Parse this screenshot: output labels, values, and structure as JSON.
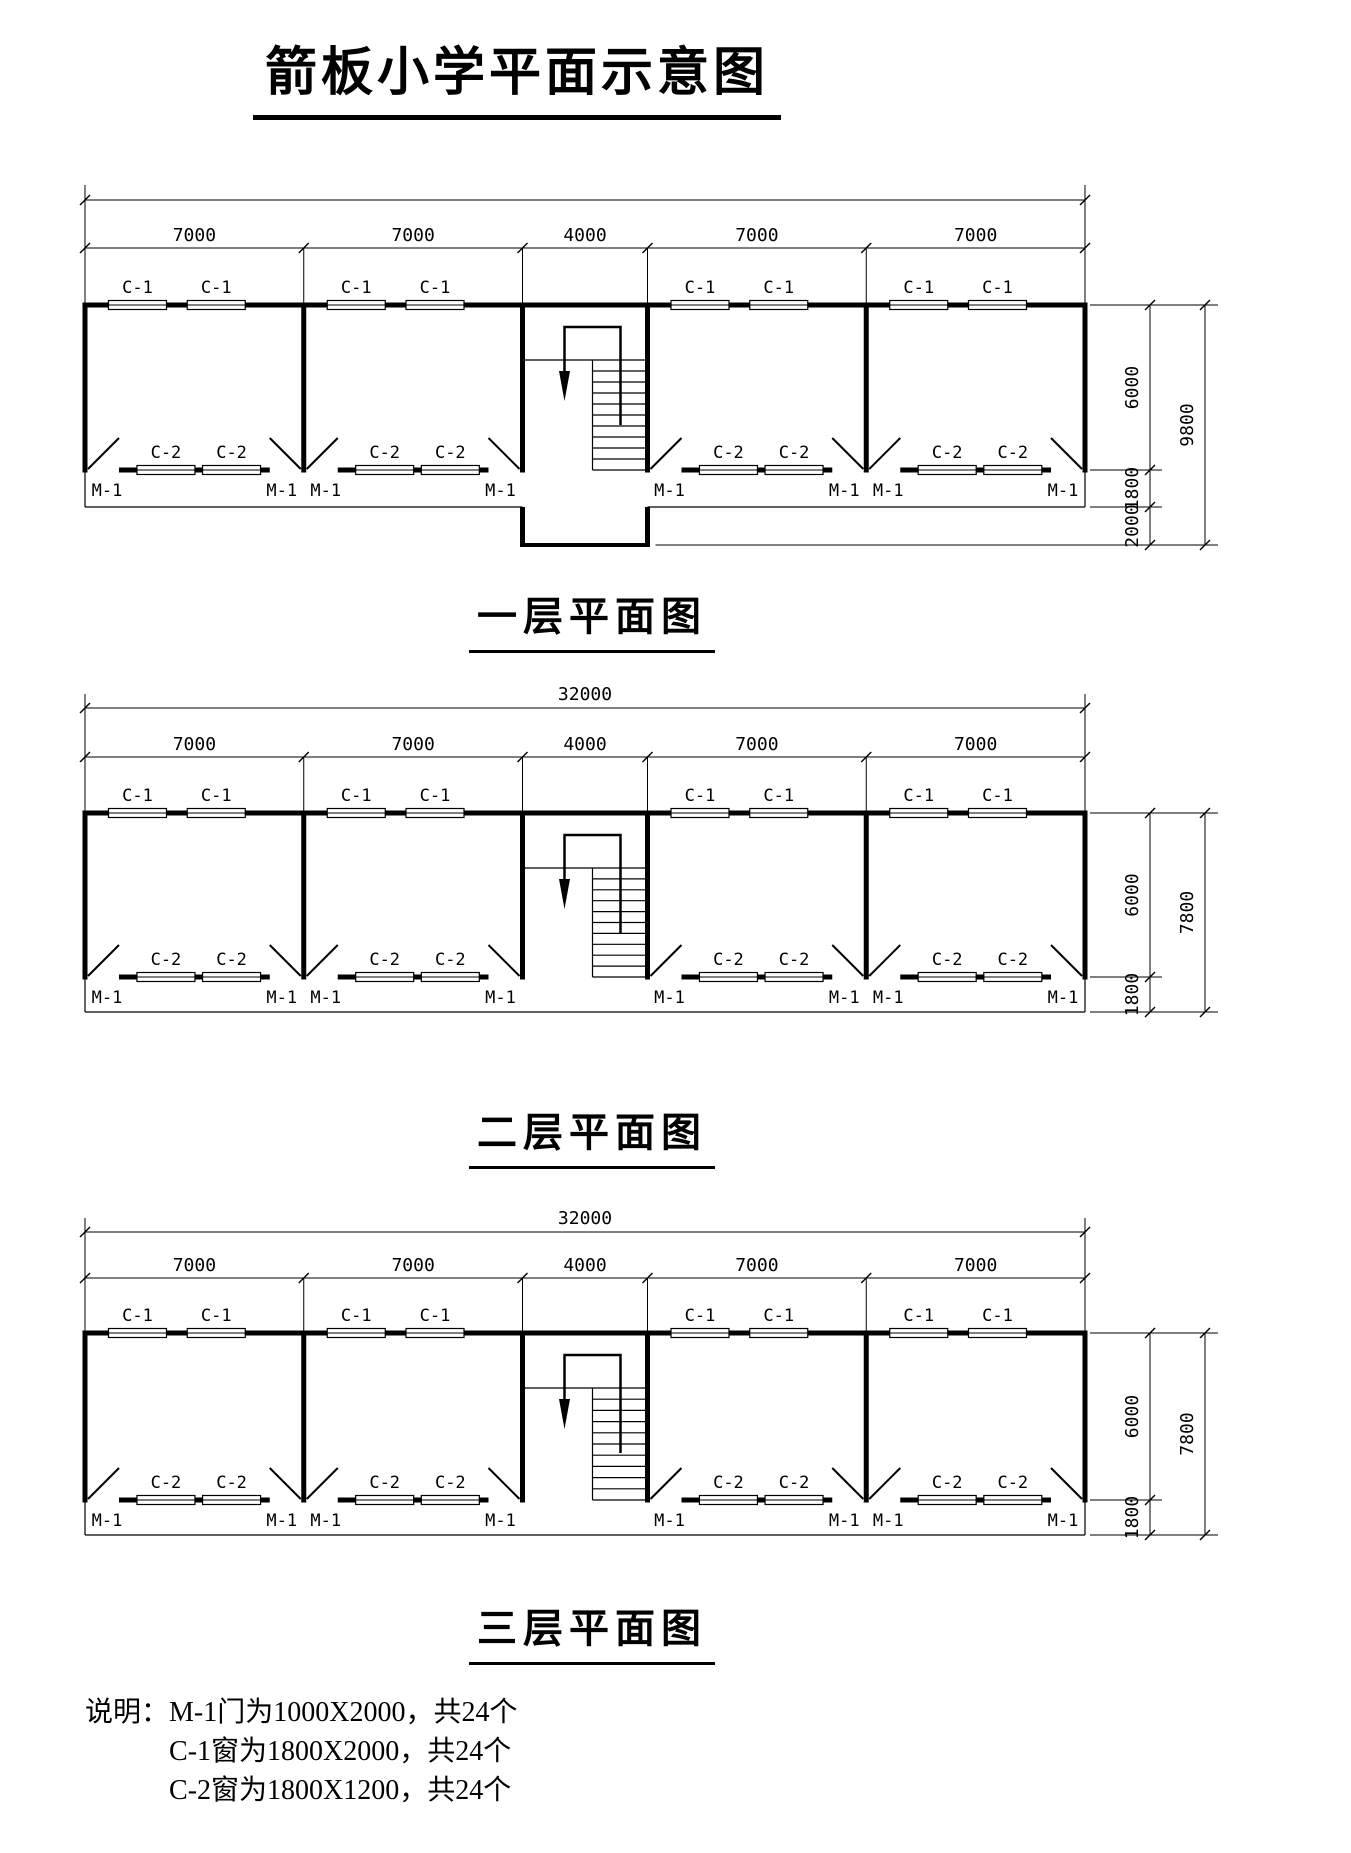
{
  "page_title": "箭板小学平面示意图",
  "labels": {
    "top_window": "C-1",
    "bottom_window": "C-2",
    "door": "M-1"
  },
  "floors": [
    {
      "name": "一层平面图",
      "overall_dim": "",
      "bay_dims": [
        "7000",
        "7000",
        "4000",
        "7000",
        "7000"
      ],
      "right_dims": [
        "6000",
        "1800",
        "2000"
      ],
      "right_total": "9800",
      "has_porch": true
    },
    {
      "name": "二层平面图",
      "overall_dim": "32000",
      "bay_dims": [
        "7000",
        "7000",
        "4000",
        "7000",
        "7000"
      ],
      "right_dims": [
        "6000",
        "1800"
      ],
      "right_total": "7800",
      "has_porch": false
    },
    {
      "name": "三层平面图",
      "overall_dim": "32000",
      "bay_dims": [
        "7000",
        "7000",
        "4000",
        "7000",
        "7000"
      ],
      "right_dims": [
        "6000",
        "1800"
      ],
      "right_total": "7800",
      "has_porch": false
    }
  ],
  "notes": {
    "prefix": "说明：",
    "lines": [
      "M-1门为1000X2000，共24个",
      "C-1窗为1800X2000，共24个",
      "C-2窗为1800X1200，共24个"
    ]
  }
}
